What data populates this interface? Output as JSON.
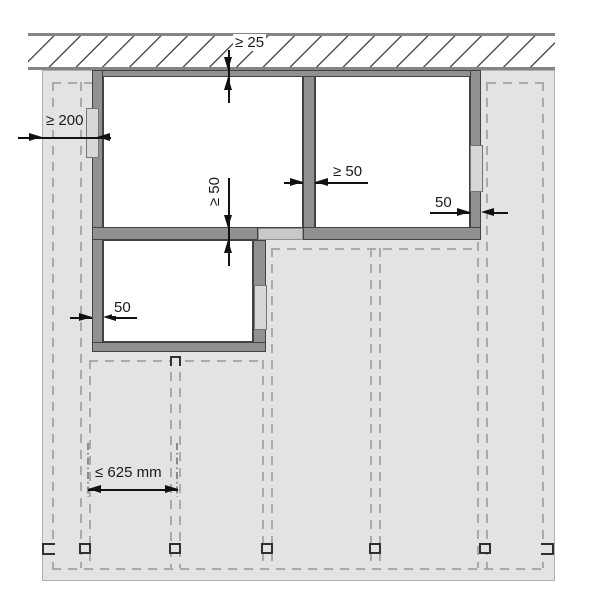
{
  "diagram_type": "roof-window installation clearance detail (plan view)",
  "units": "mm",
  "labels": {
    "clearance_top": "≥ 25",
    "clearance_edge": "≥ 200",
    "batten_gap": "≥ 50",
    "opening_side_gap": "≥ 50",
    "batten_offset_right": "50",
    "batten_offset_left": "50",
    "rafter_spacing": "≤ 625 mm"
  },
  "colors": {
    "roof_panel": "#e3e3e5",
    "batten_frame": "#8f9193",
    "batten_segment": "#d7d7d9",
    "wall_hatch_line": "#505254",
    "dashed_line": "#a8aaac",
    "dimension": "#111111"
  }
}
